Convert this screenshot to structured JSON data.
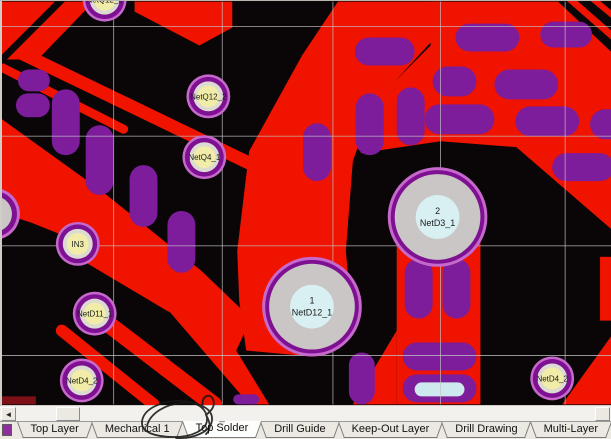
{
  "app": {
    "description": "PCB layout editor viewport with layer tabs",
    "selected_layer_tab": "Top Solder"
  },
  "colors": {
    "board": "#0A0608",
    "copper": "#EF1300",
    "copper_dark": "#7E1018",
    "pill": "#7E1D9B",
    "pill_inner_blue": "#CDE9EE",
    "grid": "#C4C4C4",
    "chrome": "#ECE9E2",
    "swatch": "#8E2E9E",
    "pad_ring_fringe": "#C668CC",
    "pad_ring": "#7E1092",
    "pad_mid_gray": "#DDD9D3",
    "pad_yellow": "#F1EDA8",
    "pad_body_gray": "#CBC6C6",
    "pad_center_cyan": "#D9F0F3",
    "pad_text": "#1c1c1c"
  },
  "canvas": {
    "grid": {
      "vertical": [
        112,
        221,
        332,
        440,
        565
      ],
      "horizontal": [
        25,
        135,
        245,
        355
      ]
    },
    "pads_small": [
      {
        "x": 103,
        "y": -2,
        "label": "NetQ12_2"
      },
      {
        "x": 207,
        "y": 95,
        "label": "NetQ12_2"
      },
      {
        "x": 203,
        "y": 156,
        "label": "NetQ4_1"
      },
      {
        "x": 76,
        "y": 243,
        "label": "IN3"
      },
      {
        "x": 93,
        "y": 313,
        "label": "NetD11_1"
      },
      {
        "x": 80,
        "y": 380,
        "label": "NetD4_2"
      },
      {
        "x": 552,
        "y": 378,
        "label": "NetD4_2"
      }
    ],
    "pads_large": [
      {
        "x": 437,
        "y": 216,
        "number": "2",
        "label": "NetD3_1"
      },
      {
        "x": 311,
        "y": 306,
        "number": "1",
        "label": "NetD12_1"
      }
    ],
    "pads_edge": [
      {
        "x": -8,
        "y": 213,
        "label": ""
      }
    ]
  },
  "scrollbar": {
    "left_arrow": "◄",
    "right_button": ""
  },
  "tabs": {
    "items": [
      {
        "label": "Top Layer",
        "selected": false
      },
      {
        "label": "Mechanical 1",
        "selected": false
      },
      {
        "label": "Top Solder",
        "selected": true,
        "annotated": true
      },
      {
        "label": "Drill Guide",
        "selected": false
      },
      {
        "label": "Keep-Out Layer",
        "selected": false
      },
      {
        "label": "Drill Drawing",
        "selected": false
      },
      {
        "label": "Multi-Layer",
        "selected": false
      }
    ]
  },
  "annotation": {
    "type": "hand-drawn-circle",
    "around_tab": "Top Solder"
  }
}
